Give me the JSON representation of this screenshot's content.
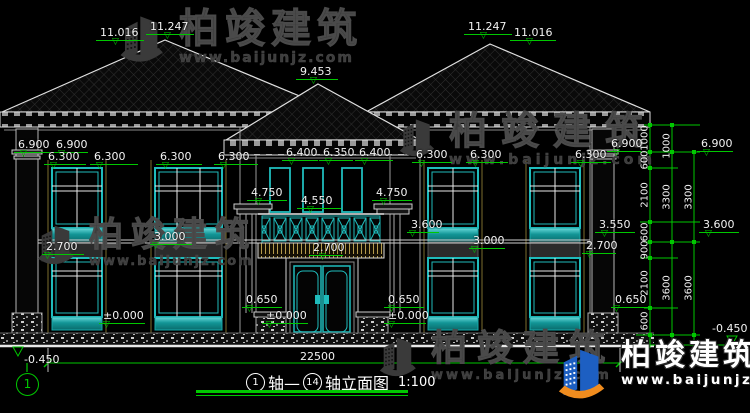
{
  "watermark": {
    "brand": "柏竣建筑",
    "url": "www.baijunjz.com"
  },
  "title_block": {
    "axis_from": "1",
    "joiner": "轴—",
    "axis_to": "14",
    "name": "轴立面图",
    "scale": "1:100"
  },
  "dims": {
    "total_width": "22500"
  },
  "axis_bubble": "1",
  "colors": {
    "dim_green": "#00c800",
    "window_teal": "#1fbcbc",
    "fascia_tan": "#b59b4c",
    "logo_blue": "#1d5fc2",
    "logo_orange": "#f08c1e",
    "watermark_gray": "#3d3d3d"
  },
  "elevation_labels": [
    {
      "t": "11.016",
      "x": 96,
      "y": 27,
      "lw": 48,
      "tp": 16
    },
    {
      "t": "11.247",
      "x": 146,
      "y": 21,
      "lw": 48,
      "tp": 18
    },
    {
      "t": "9.453",
      "x": 296,
      "y": 66,
      "lw": 42,
      "tp": 14
    },
    {
      "t": "11.247",
      "x": 464,
      "y": 21,
      "lw": 48,
      "tp": 16
    },
    {
      "t": "11.016",
      "x": 510,
      "y": 27,
      "lw": 46,
      "tp": 16
    },
    {
      "t": "6.900",
      "x": 14,
      "y": 139,
      "lw": 36,
      "tp": 6
    },
    {
      "t": "6.900",
      "x": 52,
      "y": 139,
      "lw": 36,
      "tp": 6
    },
    {
      "t": "6.300",
      "x": 44,
      "y": 151,
      "lw": 42,
      "tp": 6
    },
    {
      "t": "6.300",
      "x": 90,
      "y": 151,
      "lw": 48,
      "tp": 6
    },
    {
      "t": "6.300",
      "x": 156,
      "y": 151,
      "lw": 46,
      "tp": 6
    },
    {
      "t": "6.300",
      "x": 214,
      "y": 151,
      "lw": 44,
      "tp": 6
    },
    {
      "t": "6.400",
      "x": 282,
      "y": 147,
      "lw": 36,
      "tp": 6
    },
    {
      "t": "6.350",
      "x": 319,
      "y": 147,
      "lw": 34,
      "tp": 6
    },
    {
      "t": "6.400",
      "x": 355,
      "y": 147,
      "lw": 38,
      "tp": 6
    },
    {
      "t": "6.300",
      "x": 412,
      "y": 149,
      "lw": 40,
      "tp": 6
    },
    {
      "t": "6.300",
      "x": 466,
      "y": 149,
      "lw": 42,
      "tp": 6
    },
    {
      "t": "6.300",
      "x": 571,
      "y": 149,
      "lw": 40,
      "tp": 6
    },
    {
      "t": "6.900",
      "x": 607,
      "y": 138,
      "lw": 34,
      "tp": 6
    },
    {
      "t": "6.900",
      "x": 697,
      "y": 138,
      "lw": 36,
      "tp": 6
    },
    {
      "t": "4.750",
      "x": 247,
      "y": 187,
      "lw": 40,
      "tp": 8
    },
    {
      "t": "4.550",
      "x": 297,
      "y": 195,
      "lw": 44,
      "tp": 10
    },
    {
      "t": "4.750",
      "x": 372,
      "y": 187,
      "lw": 40,
      "tp": 8
    },
    {
      "t": "2.700",
      "x": 42,
      "y": 241,
      "lw": 42,
      "tp": 2
    },
    {
      "t": "3.000",
      "x": 150,
      "y": 231,
      "lw": 42,
      "tp": 2
    },
    {
      "t": "3.600",
      "x": 407,
      "y": 219,
      "lw": 32,
      "tp": 2
    },
    {
      "t": "3.000",
      "x": 469,
      "y": 235,
      "lw": 36,
      "tp": 2
    },
    {
      "t": "2.700",
      "x": 309,
      "y": 242,
      "lw": 34,
      "tp": 10
    },
    {
      "t": "3.550",
      "x": 595,
      "y": 219,
      "lw": 40,
      "tp": 6
    },
    {
      "t": "3.600",
      "x": 699,
      "y": 219,
      "lw": 40,
      "tp": 6
    },
    {
      "t": "2.700",
      "x": 582,
      "y": 240,
      "lw": 34,
      "tp": 4
    },
    {
      "t": "0.650",
      "x": 242,
      "y": 294,
      "lw": 40,
      "tp": 4
    },
    {
      "t": "0.650",
      "x": 384,
      "y": 294,
      "lw": 40,
      "tp": 4
    },
    {
      "t": "0.650",
      "x": 611,
      "y": 294,
      "lw": 40,
      "tp": 2
    },
    {
      "t": "±0.000",
      "x": 99,
      "y": 310,
      "lw": 46,
      "tp": 4
    },
    {
      "t": "±0.000",
      "x": 262,
      "y": 310,
      "lw": 46,
      "tp": 4
    },
    {
      "t": "±0.000",
      "x": 384,
      "y": 310,
      "lw": 42,
      "tp": 4
    },
    {
      "t": "-0.450",
      "x": 20,
      "y": 354,
      "lw": 0
    },
    {
      "t": "-0.450",
      "x": 708,
      "y": 323,
      "lw": 0
    }
  ],
  "vertical_dims": [
    {
      "t": "1000",
      "x": 645,
      "y": 138
    },
    {
      "t": "600",
      "x": 645,
      "y": 160
    },
    {
      "t": "2100",
      "x": 645,
      "y": 195
    },
    {
      "t": "600",
      "x": 645,
      "y": 232
    },
    {
      "t": "900",
      "x": 645,
      "y": 250
    },
    {
      "t": "2100",
      "x": 645,
      "y": 283
    },
    {
      "t": "600",
      "x": 645,
      "y": 321
    },
    {
      "t": "1000",
      "x": 667,
      "y": 146
    },
    {
      "t": "3300",
      "x": 667,
      "y": 197
    },
    {
      "t": "3600",
      "x": 667,
      "y": 288
    },
    {
      "t": "3300",
      "x": 689,
      "y": 197
    },
    {
      "t": "3600",
      "x": 689,
      "y": 288
    }
  ]
}
